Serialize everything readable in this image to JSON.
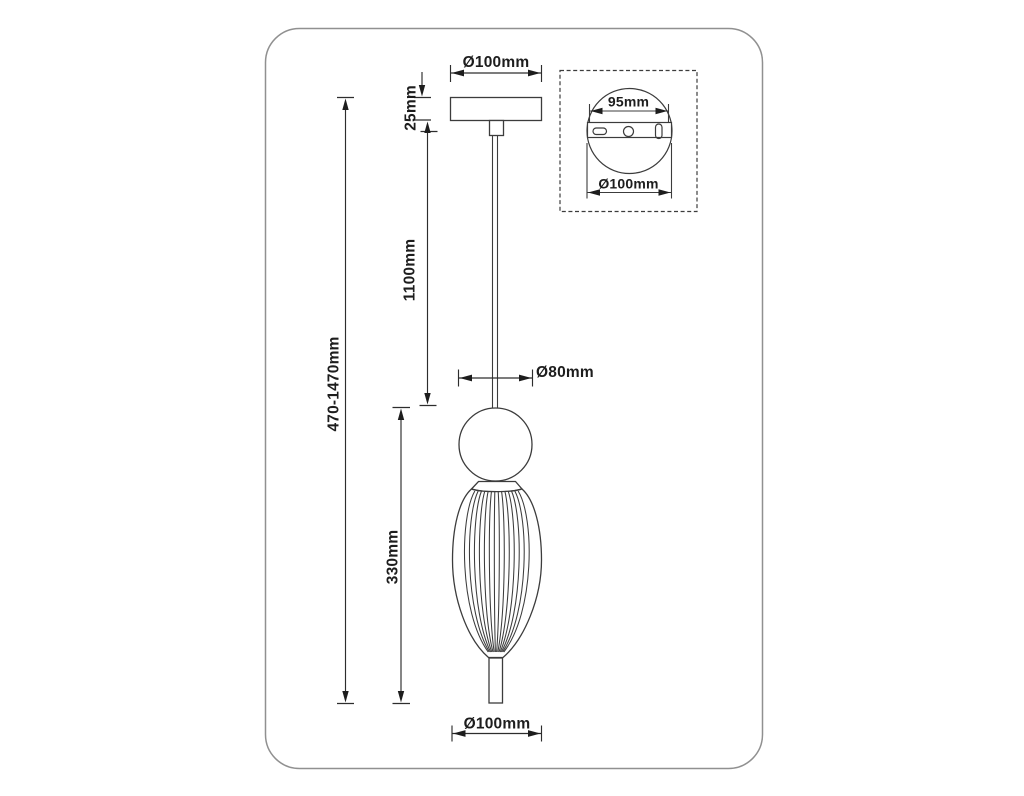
{
  "drawing": {
    "type": "pendant-lamp-dimension-diagram",
    "unit": "mm",
    "labels": {
      "canopy_diameter": "Ø100mm",
      "canopy_height": "25mm",
      "suspension_length": "1100mm",
      "overall_height": "470-1470mm",
      "ball_diameter": "Ø80mm",
      "shade_height": "330mm",
      "shade_diameter": "Ø100mm"
    },
    "inset": {
      "mounting_plate_width": "95mm",
      "canopy_plate_diameter": "Ø100mm"
    },
    "colors": {
      "line": "#3c3c3c",
      "text": "#1d1d1d",
      "frame_border": "#909090",
      "background": "#ffffff"
    }
  }
}
